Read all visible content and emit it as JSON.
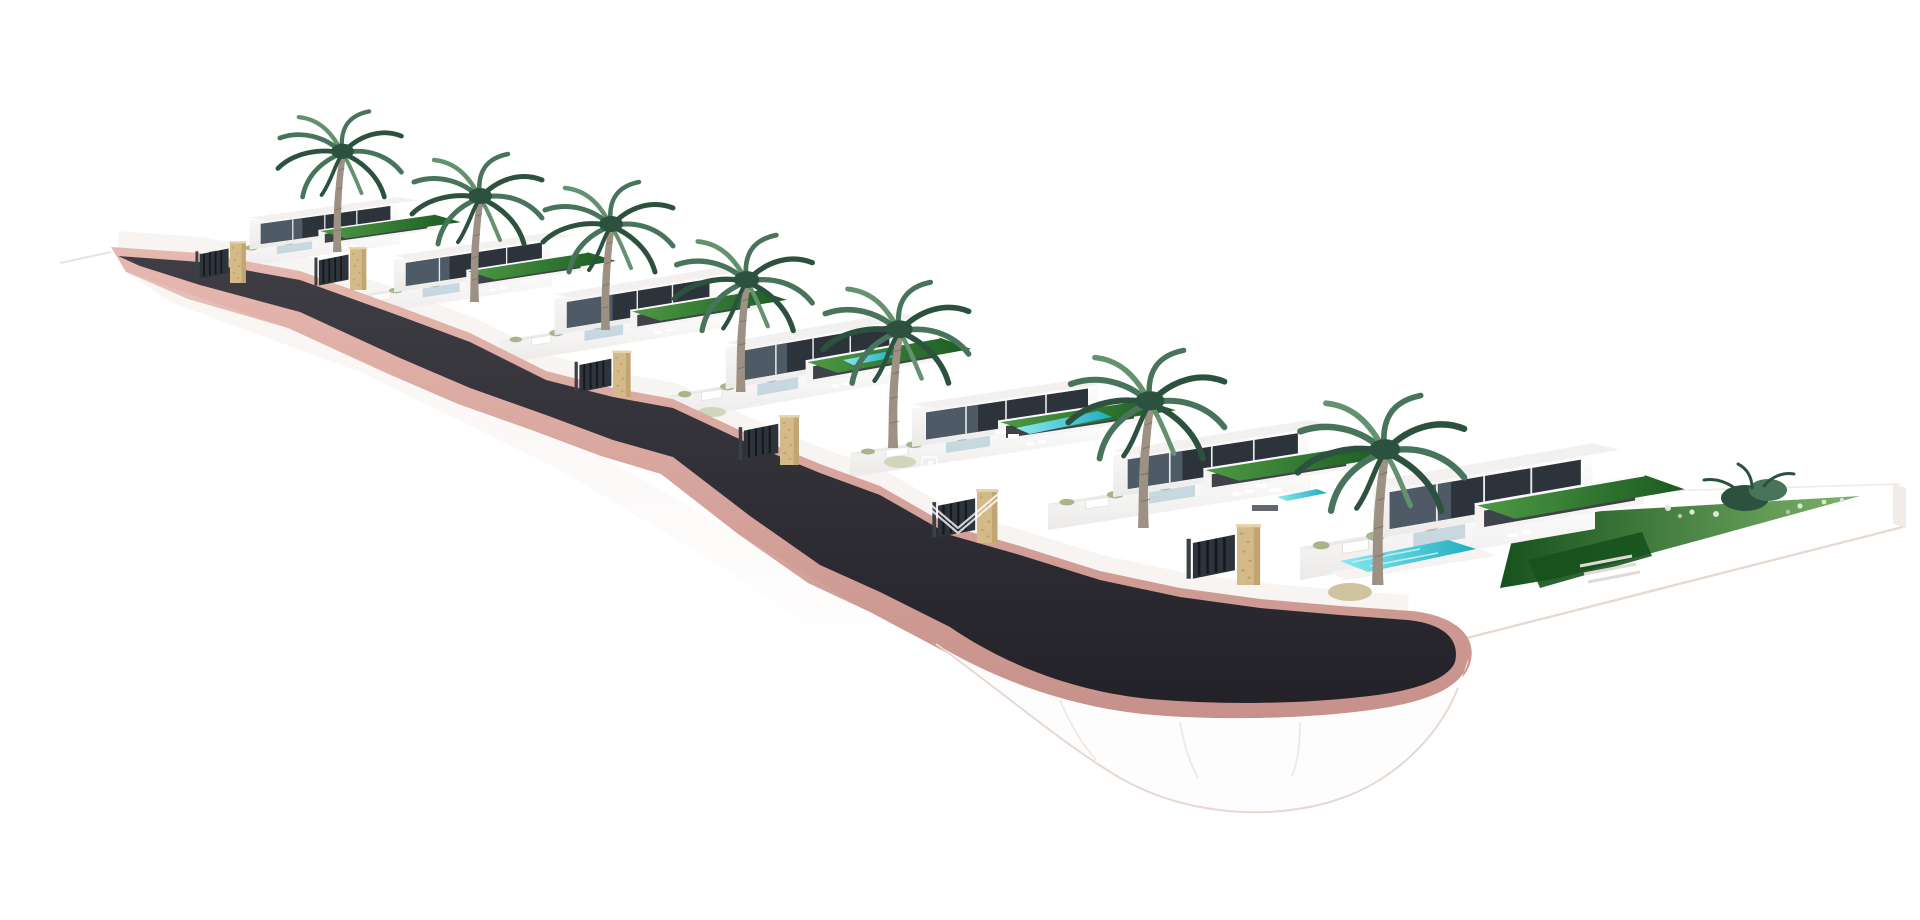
{
  "watermark": {
    "line1": "PROPERTIES",
    "line2": "SPAIN",
    "logo": "properties-spain-house-logo",
    "mark": "double-check-brand-mark"
  },
  "scene": {
    "kind": "architectural 3D render",
    "objects": [
      "hillside-terrain",
      "access-road",
      "road-curb",
      "cul-de-sac",
      "retaining-walls",
      "villa-1",
      "villa-2",
      "villa-3",
      "villa-4",
      "villa-5",
      "villa-6",
      "villa-7",
      "palm-tree-1",
      "palm-tree-2",
      "palm-tree-3",
      "palm-tree-4",
      "palm-tree-5",
      "palm-tree-6",
      "palm-tree-7",
      "entrance-pillar-1",
      "entrance-pillar-2",
      "entrance-pillar-3",
      "entrance-pillar-4",
      "entrance-pillar-5",
      "entrance-pillar-6",
      "entrance-gate-1",
      "entrance-gate-2",
      "entrance-gate-3",
      "entrance-gate-4",
      "entrance-gate-5",
      "entrance-gate-6",
      "pool-villa-4",
      "pool-villa-5",
      "pool-villa-6",
      "pool-villa-7",
      "green-roofs",
      "right-lawn",
      "shrub-cluster",
      "flower-shrubs"
    ],
    "villa_count": 7,
    "palm_count": 7,
    "pillar_count": 6,
    "pool_count": 4
  },
  "colors": {
    "bg": "#ffffff",
    "asphalt-1": "#3f3e44",
    "asphalt-2": "#232228",
    "salmon-1": "#e6b8af",
    "salmon-2": "#c6918a",
    "wall-white": "#fdfdfc",
    "wall-shade": "#eceae9",
    "wall-edge": "#e3dedb",
    "glass-dark": "#2c333b",
    "glass-mid": "#55636e",
    "glass-light": "#b7cdd8",
    "green-roof-1": "#4f9a44",
    "green-roof-2": "#1b5a22",
    "lawn-1": "#17521d",
    "lawn-2": "#7cb46a",
    "pool-1": "#8ae8ee",
    "pool-2": "#1fadc0",
    "sandstone": "#d4ba88",
    "sandstone-dark": "#b2945f",
    "gate": "#2e343b",
    "gate-bar": "#15191e",
    "palm-dark": "#2c523f",
    "palm-mid": "#47745a",
    "palm-light": "#64926f",
    "trunk": "#9c9183",
    "trunk-dark": "#6f665c",
    "shrub": "#a9b48a",
    "shrub-light": "#dfe5d8",
    "terrain-shadow": "#eadcd5",
    "terrain-edge": "#e6d9d2",
    "watermark": "#ffffff"
  }
}
